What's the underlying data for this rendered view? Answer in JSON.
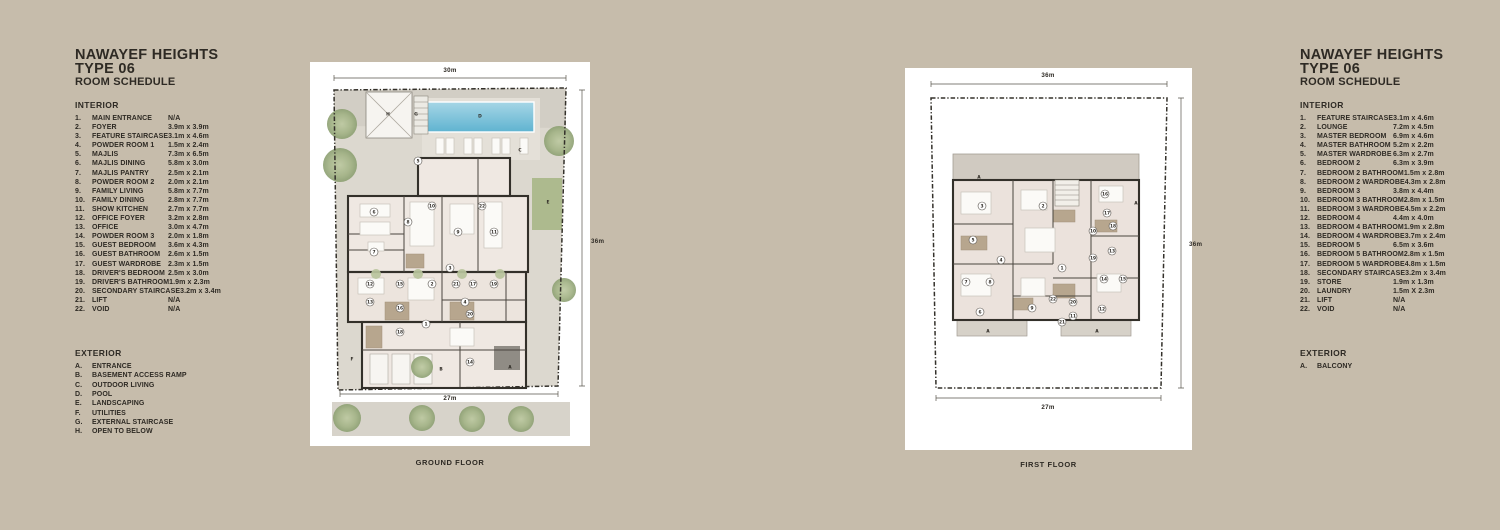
{
  "colors": {
    "background": "#c6bcab",
    "card": "#ffffff",
    "ink": "#2e2a24",
    "pool_blue": "#6cbcd6",
    "tree_green": "#a3b386",
    "lawn_green": "#adba8e",
    "wall_dark": "#33302a",
    "floor": "#efe8e2",
    "paving": "#dcd8cf"
  },
  "left_panel": {
    "title_line1": "NAWAYEF HEIGHTS",
    "title_line2": "TYPE 06",
    "title_line3": "ROOM SCHEDULE",
    "interior_heading": "INTERIOR",
    "interior_items": [
      {
        "num": "1.",
        "name": "MAIN ENTRANCE",
        "dims": "N/A"
      },
      {
        "num": "2.",
        "name": "FOYER",
        "dims": "3.9m x 3.9m"
      },
      {
        "num": "3.",
        "name": "FEATURE STAIRCASE",
        "dims": "3.1m x 4.6m"
      },
      {
        "num": "4.",
        "name": "POWDER ROOM 1",
        "dims": "1.5m x 2.4m"
      },
      {
        "num": "5.",
        "name": "MAJLIS",
        "dims": "7.3m x 6.5m"
      },
      {
        "num": "6.",
        "name": "MAJLIS DINING",
        "dims": "5.8m x 3.0m"
      },
      {
        "num": "7.",
        "name": "MAJLIS PANTRY",
        "dims": "2.5m x 2.1m"
      },
      {
        "num": "8.",
        "name": "POWDER ROOM 2",
        "dims": "2.0m x 2.1m"
      },
      {
        "num": "9.",
        "name": "FAMILY LIVING",
        "dims": "5.8m x 7.7m"
      },
      {
        "num": "10.",
        "name": "FAMILY DINING",
        "dims": "2.8m x 7.7m"
      },
      {
        "num": "11.",
        "name": "SHOW KITCHEN",
        "dims": "2.7m x 7.7m"
      },
      {
        "num": "12.",
        "name": "OFFICE FOYER",
        "dims": "3.2m x 2.8m"
      },
      {
        "num": "13.",
        "name": "OFFICE",
        "dims": "3.0m x 4.7m"
      },
      {
        "num": "14.",
        "name": "POWDER ROOM 3",
        "dims": "2.0m x 1.8m"
      },
      {
        "num": "15.",
        "name": "GUEST BEDROOM",
        "dims": "3.6m x 4.3m"
      },
      {
        "num": "16.",
        "name": "GUEST BATHROOM",
        "dims": "2.6m x 1.5m"
      },
      {
        "num": "17.",
        "name": "GUEST WARDROBE",
        "dims": "2.3m x 1.5m"
      },
      {
        "num": "18.",
        "name": "DRIVER'S BEDROOM",
        "dims": "2.5m x 3.0m"
      },
      {
        "num": "19.",
        "name": "DRIVER'S BATHROOM",
        "dims": "1.9m x 2.3m"
      },
      {
        "num": "20.",
        "name": "SECONDARY STAIRCASE",
        "dims": "3.2m x 3.4m"
      },
      {
        "num": "21.",
        "name": "LIFT",
        "dims": "N/A"
      },
      {
        "num": "22.",
        "name": "VOID",
        "dims": "N/A"
      }
    ],
    "exterior_heading": "EXTERIOR",
    "exterior_items": [
      {
        "num": "A.",
        "name": "ENTRANCE"
      },
      {
        "num": "B.",
        "name": "BASEMENT ACCESS RAMP"
      },
      {
        "num": "C.",
        "name": "OUTDOOR LIVING"
      },
      {
        "num": "D.",
        "name": "POOL"
      },
      {
        "num": "E.",
        "name": "LANDSCAPING"
      },
      {
        "num": "F.",
        "name": "UTILITIES"
      },
      {
        "num": "G.",
        "name": "EXTERNAL STAIRCASE"
      },
      {
        "num": "H.",
        "name": "OPEN TO BELOW"
      }
    ]
  },
  "right_panel": {
    "title_line1": "NAWAYEF HEIGHTS",
    "title_line2": "TYPE 06",
    "title_line3": "ROOM SCHEDULE",
    "interior_heading": "INTERIOR",
    "interior_items": [
      {
        "num": "1.",
        "name": "FEATURE STAIRCASE",
        "dims": "3.1m x 4.6m"
      },
      {
        "num": "2.",
        "name": "LOUNGE",
        "dims": "7.2m x 4.5m"
      },
      {
        "num": "3.",
        "name": "MASTER BEDROOM",
        "dims": "6.9m x 4.6m"
      },
      {
        "num": "4.",
        "name": "MASTER BATHROOM",
        "dims": "5.2m x 2.2m"
      },
      {
        "num": "5.",
        "name": "MASTER WARDROBE",
        "dims": "6.3m x 2.7m"
      },
      {
        "num": "6.",
        "name": "BEDROOM 2",
        "dims": "6.3m x 3.9m"
      },
      {
        "num": "7.",
        "name": "BEDROOM 2 BATHROOM",
        "dims": "1.5m x 2.8m"
      },
      {
        "num": "8.",
        "name": "BEDROOM 2 WARDROBE",
        "dims": "4.3m x 2.8m"
      },
      {
        "num": "9.",
        "name": "BEDROOM 3",
        "dims": "3.8m x 4.4m"
      },
      {
        "num": "10.",
        "name": "BEDROOM 3 BATHROOM",
        "dims": "2.8m x 1.5m"
      },
      {
        "num": "11.",
        "name": "BEDROOM 3 WARDROBE",
        "dims": "4.5m x 2.2m"
      },
      {
        "num": "12.",
        "name": "BEDROOM 4",
        "dims": "4.4m x 4.0m"
      },
      {
        "num": "13.",
        "name": "BEDROOM 4 BATHROOM",
        "dims": "1.9m x 2.8m"
      },
      {
        "num": "14.",
        "name": "BEDROOM 4 WARDROBE",
        "dims": "3.7m x 2.4m"
      },
      {
        "num": "15.",
        "name": "BEDROOM 5",
        "dims": "6.5m x 3.6m"
      },
      {
        "num": "16.",
        "name": "BEDROOM 5 BATHROOM",
        "dims": "2.8m x 1.5m"
      },
      {
        "num": "17.",
        "name": "BEDROOM 5 WARDROBE",
        "dims": "4.8m x 1.5m"
      },
      {
        "num": "18.",
        "name": "SECONDARY STAIRCASE",
        "dims": "3.2m x 3.4m"
      },
      {
        "num": "19.",
        "name": "STORE",
        "dims": "1.9m x 1.3m"
      },
      {
        "num": "20.",
        "name": "LAUNDRY",
        "dims": "1.5m X 2.3m"
      },
      {
        "num": "21.",
        "name": "LIFT",
        "dims": "N/A"
      },
      {
        "num": "22.",
        "name": "VOID",
        "dims": "N/A"
      }
    ],
    "exterior_heading": "EXTERIOR",
    "exterior_items": [
      {
        "num": "A.",
        "name": "BALCONY"
      }
    ]
  },
  "ground_floor": {
    "caption": "GROUND FLOOR",
    "dim_top": "30m",
    "dim_right": "36m",
    "dim_bottom": "27m",
    "markers": [
      {
        "label": "1",
        "x": 116,
        "y": 262
      },
      {
        "label": "2",
        "x": 122,
        "y": 222
      },
      {
        "label": "3",
        "x": 140,
        "y": 206
      },
      {
        "label": "4",
        "x": 155,
        "y": 240
      },
      {
        "label": "5",
        "x": 108,
        "y": 99
      },
      {
        "label": "6",
        "x": 64,
        "y": 150
      },
      {
        "label": "7",
        "x": 64,
        "y": 190
      },
      {
        "label": "8",
        "x": 98,
        "y": 160
      },
      {
        "label": "9",
        "x": 148,
        "y": 170
      },
      {
        "label": "10",
        "x": 122,
        "y": 144
      },
      {
        "label": "11",
        "x": 184,
        "y": 170
      },
      {
        "label": "12",
        "x": 60,
        "y": 222
      },
      {
        "label": "13",
        "x": 60,
        "y": 240
      },
      {
        "label": "14",
        "x": 160,
        "y": 300
      },
      {
        "label": "15",
        "x": 90,
        "y": 222
      },
      {
        "label": "16",
        "x": 90,
        "y": 246
      },
      {
        "label": "17",
        "x": 163,
        "y": 222
      },
      {
        "label": "18",
        "x": 90,
        "y": 270
      },
      {
        "label": "19",
        "x": 184,
        "y": 222
      },
      {
        "label": "20",
        "x": 160,
        "y": 252
      },
      {
        "label": "21",
        "x": 146,
        "y": 222
      },
      {
        "label": "22",
        "x": 172,
        "y": 144
      },
      {
        "label": "A",
        "x": 200,
        "y": 305
      },
      {
        "label": "B",
        "x": 131,
        "y": 307
      },
      {
        "label": "C",
        "x": 210,
        "y": 88
      },
      {
        "label": "D",
        "x": 170,
        "y": 54
      },
      {
        "label": "E",
        "x": 238,
        "y": 140
      },
      {
        "label": "F",
        "x": 42,
        "y": 297
      },
      {
        "label": "G",
        "x": 106,
        "y": 52
      },
      {
        "label": "H",
        "x": 78,
        "y": 52
      }
    ]
  },
  "first_floor": {
    "caption": "FIRST FLOOR",
    "dim_top": "36m",
    "dim_right": "36m",
    "dim_bottom": "27m",
    "markers": [
      {
        "label": "1",
        "x": 157,
        "y": 200
      },
      {
        "label": "2",
        "x": 138,
        "y": 138
      },
      {
        "label": "3",
        "x": 77,
        "y": 138
      },
      {
        "label": "4",
        "x": 96,
        "y": 192
      },
      {
        "label": "5",
        "x": 68,
        "y": 172
      },
      {
        "label": "6",
        "x": 75,
        "y": 244
      },
      {
        "label": "7",
        "x": 61,
        "y": 214
      },
      {
        "label": "8",
        "x": 85,
        "y": 214
      },
      {
        "label": "9",
        "x": 127,
        "y": 240
      },
      {
        "label": "10",
        "x": 188,
        "y": 163
      },
      {
        "label": "11",
        "x": 168,
        "y": 248
      },
      {
        "label": "12",
        "x": 197,
        "y": 241
      },
      {
        "label": "13",
        "x": 207,
        "y": 183
      },
      {
        "label": "14",
        "x": 199,
        "y": 211
      },
      {
        "label": "15",
        "x": 218,
        "y": 211
      },
      {
        "label": "16",
        "x": 200,
        "y": 126
      },
      {
        "label": "17",
        "x": 202,
        "y": 145
      },
      {
        "label": "18",
        "x": 208,
        "y": 158
      },
      {
        "label": "19",
        "x": 188,
        "y": 190
      },
      {
        "label": "20",
        "x": 168,
        "y": 234
      },
      {
        "label": "21",
        "x": 157,
        "y": 254
      },
      {
        "label": "22",
        "x": 148,
        "y": 231
      },
      {
        "label": "A",
        "x": 74,
        "y": 109
      },
      {
        "label": "A",
        "x": 231,
        "y": 135
      },
      {
        "label": "A",
        "x": 83,
        "y": 263
      },
      {
        "label": "A",
        "x": 192,
        "y": 263
      }
    ]
  }
}
